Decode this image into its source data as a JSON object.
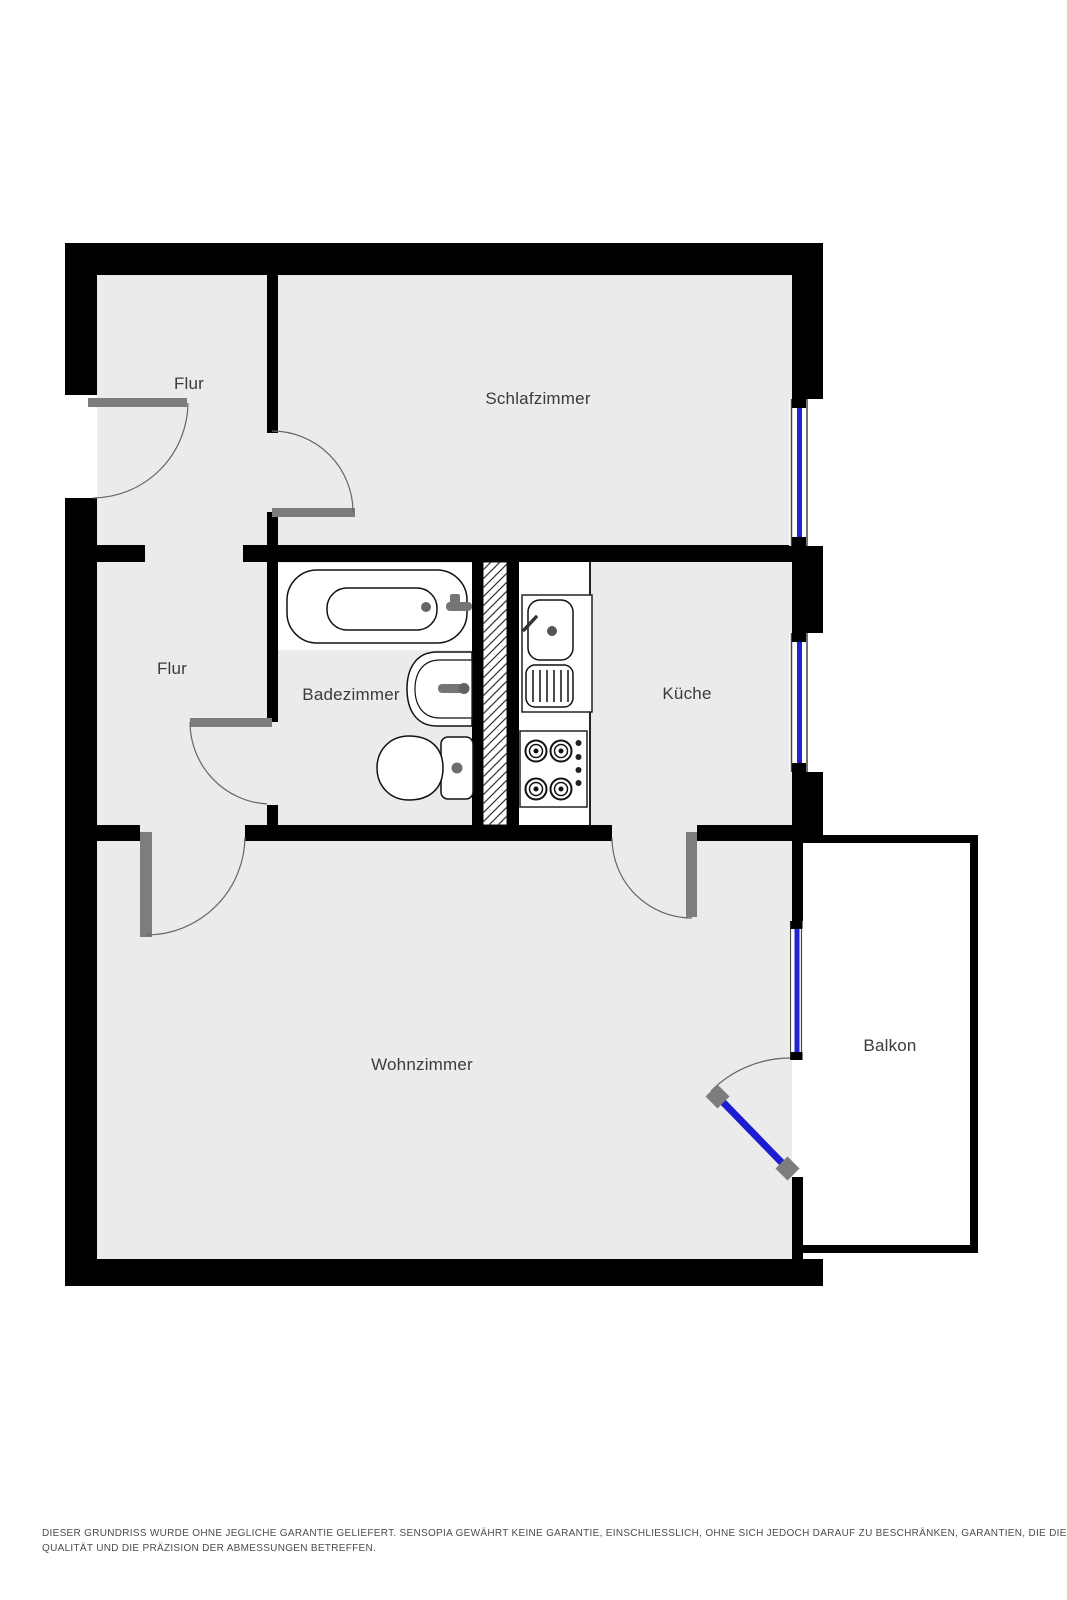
{
  "plan": {
    "rooms": [
      {
        "name": "flur-upper",
        "label": "Flur"
      },
      {
        "name": "schlafzimmer",
        "label": "Schlafzimmer"
      },
      {
        "name": "flur-lower",
        "label": "Flur"
      },
      {
        "name": "badezimmer",
        "label": "Badezimmer"
      },
      {
        "name": "kueche",
        "label": "Küche"
      },
      {
        "name": "wohnzimmer",
        "label": "Wohnzimmer"
      },
      {
        "name": "balkon",
        "label": "Balkon"
      }
    ],
    "colors": {
      "wall": "#000000",
      "floor": "#ebebeb",
      "fixture_zone": "#ffffff",
      "window_glass": "#2222d0",
      "balcony_door": "#1c1cd1",
      "door_leaf_gray": "#7d7d7d",
      "outline": "#111111",
      "label_text": "#3b3b3b"
    }
  },
  "disclaimer": {
    "line1": "DIESER GRUNDRISS WURDE OHNE JEGLICHE GARANTIE GELIEFERT. SENSOPIA GEWÄHRT KEINE GARANTIE, EINSCHLIESSLICH, OHNE SICH JEDOCH DARAUF ZU BESCHRÄNKEN, GARANTIEN, DIE DIE",
    "line2": "QUALITÄT UND DIE PRÄZISION DER ABMESSUNGEN BETREFFEN."
  }
}
